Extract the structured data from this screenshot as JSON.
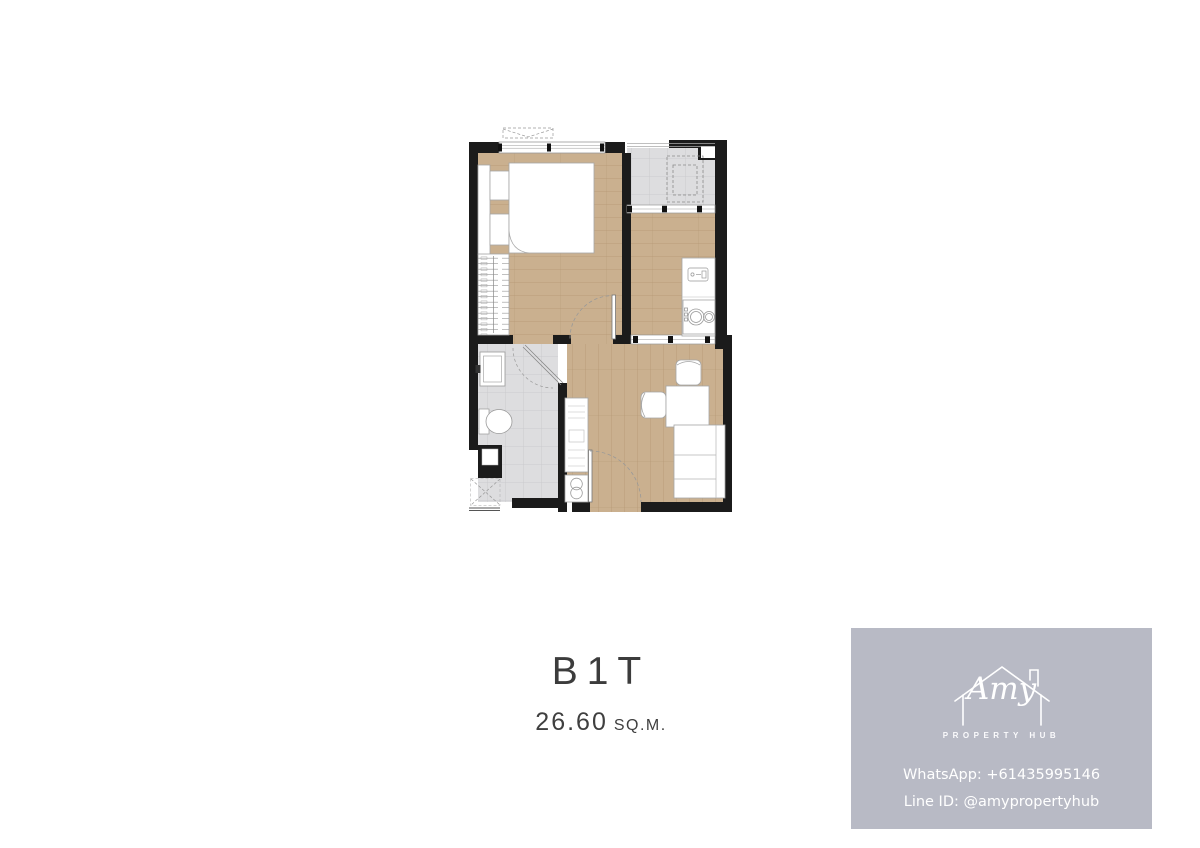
{
  "colors": {
    "background": "#ffffff",
    "wall": "#1b1b1b",
    "wood_floor": "#cab08f",
    "wood_grain": "#b0946f",
    "tile_floor": "#dddddf",
    "tile_grid": "#c7c7ca",
    "fixture_outline": "#a5a5a5",
    "title_text": "#3c3c3c",
    "card_background": "#b8bac5",
    "card_text": "#ffffff"
  },
  "plan": {
    "unit_name": "B1T",
    "area_value": "26.60",
    "area_unit": "SQ.M."
  },
  "card": {
    "brand_script": "Amy",
    "brand_sub": "PROPERTY HUB",
    "contact_whatsapp": "WhatsApp: +61435995146",
    "contact_line": "Line ID: @amypropertyhub"
  }
}
